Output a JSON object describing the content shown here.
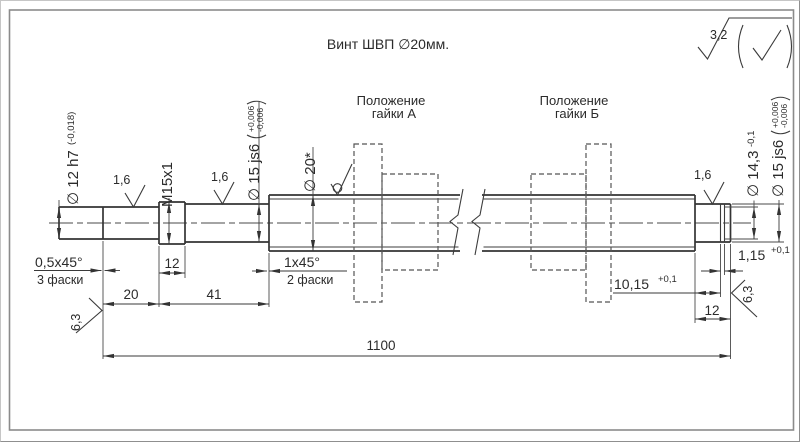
{
  "title": "Винт ШВП ∅20мм.",
  "surface_note": {
    "roughness": "3,2"
  },
  "nut_a": {
    "line1": "Положение",
    "line2": "гайки А"
  },
  "nut_b": {
    "line1": "Положение",
    "line2": "гайки Б"
  },
  "labels": {
    "dia12": {
      "main": "∅ 12 h7",
      "tol": "(-0,018)"
    },
    "thread": {
      "main": "M15x1"
    },
    "dia15_left": {
      "main": "∅ 15 js6",
      "tol_upper": "+0,006",
      "tol_lower": "-0,006"
    },
    "dia20": {
      "main": "∅ 20*"
    },
    "dia14_3": {
      "main": "∅ 14,3",
      "tol": "-0,1"
    },
    "dia15_right": {
      "main": "∅ 15 js6",
      "tol_upper": "+0,006",
      "tol_lower": "-0,006"
    }
  },
  "roughness": {
    "r1": "1,6",
    "r2": "1,6",
    "r3": "1,6",
    "left_face": "6,3",
    "right_face": "6,3"
  },
  "dims": {
    "chamfer_left": {
      "value": "0,5x45°",
      "note": "3 фаски"
    },
    "chamfer_mid": {
      "value": "1x45°",
      "note": "2 фаски"
    },
    "thread_len": "12",
    "len_20": "20",
    "len_41": "41",
    "total_len": "1100",
    "groove_pos": {
      "value": "10,15",
      "tol": "+0,1"
    },
    "groove_width": {
      "value": "1,15",
      "tol": "+0,1"
    },
    "journal_len": "12"
  }
}
